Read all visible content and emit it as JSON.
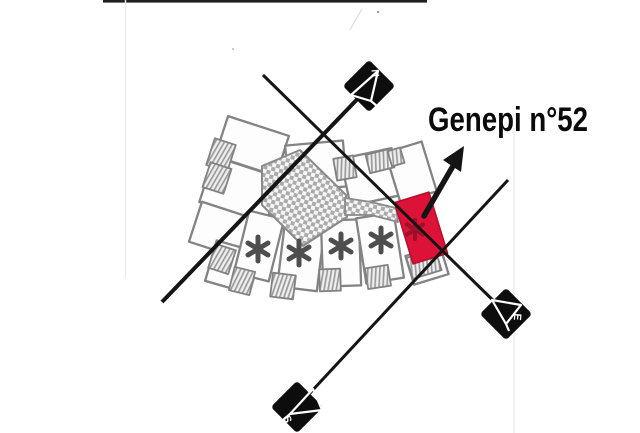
{
  "page": {
    "background_color": "#ffffff",
    "scan_border_color": "#1f1f1f"
  },
  "annotation": {
    "unit_label": "Genepi n°52",
    "text_color": "#0a0a0a",
    "arrow_color": "#141414"
  },
  "compass_markers": {
    "marker_color": "#0d0d0d",
    "glyph_color": "#ffffff",
    "north": {
      "label": "N"
    },
    "east": {
      "label": "E"
    },
    "south": {
      "label": "S"
    }
  },
  "site_plan": {
    "outline_color": "#838383",
    "unit_fill_color": "#fdfdfd",
    "checker_fill_color": "#ababab",
    "hatch_fill_color": "#9b9b9b",
    "highlighted_unit_color": "#dc1238",
    "highlighted_unit_mark": "*",
    "unit_marks": [
      "*",
      "*",
      "*",
      "*"
    ],
    "mark_color": "#4e4e4e"
  },
  "survey_lines": {
    "line_color": "#151515"
  }
}
